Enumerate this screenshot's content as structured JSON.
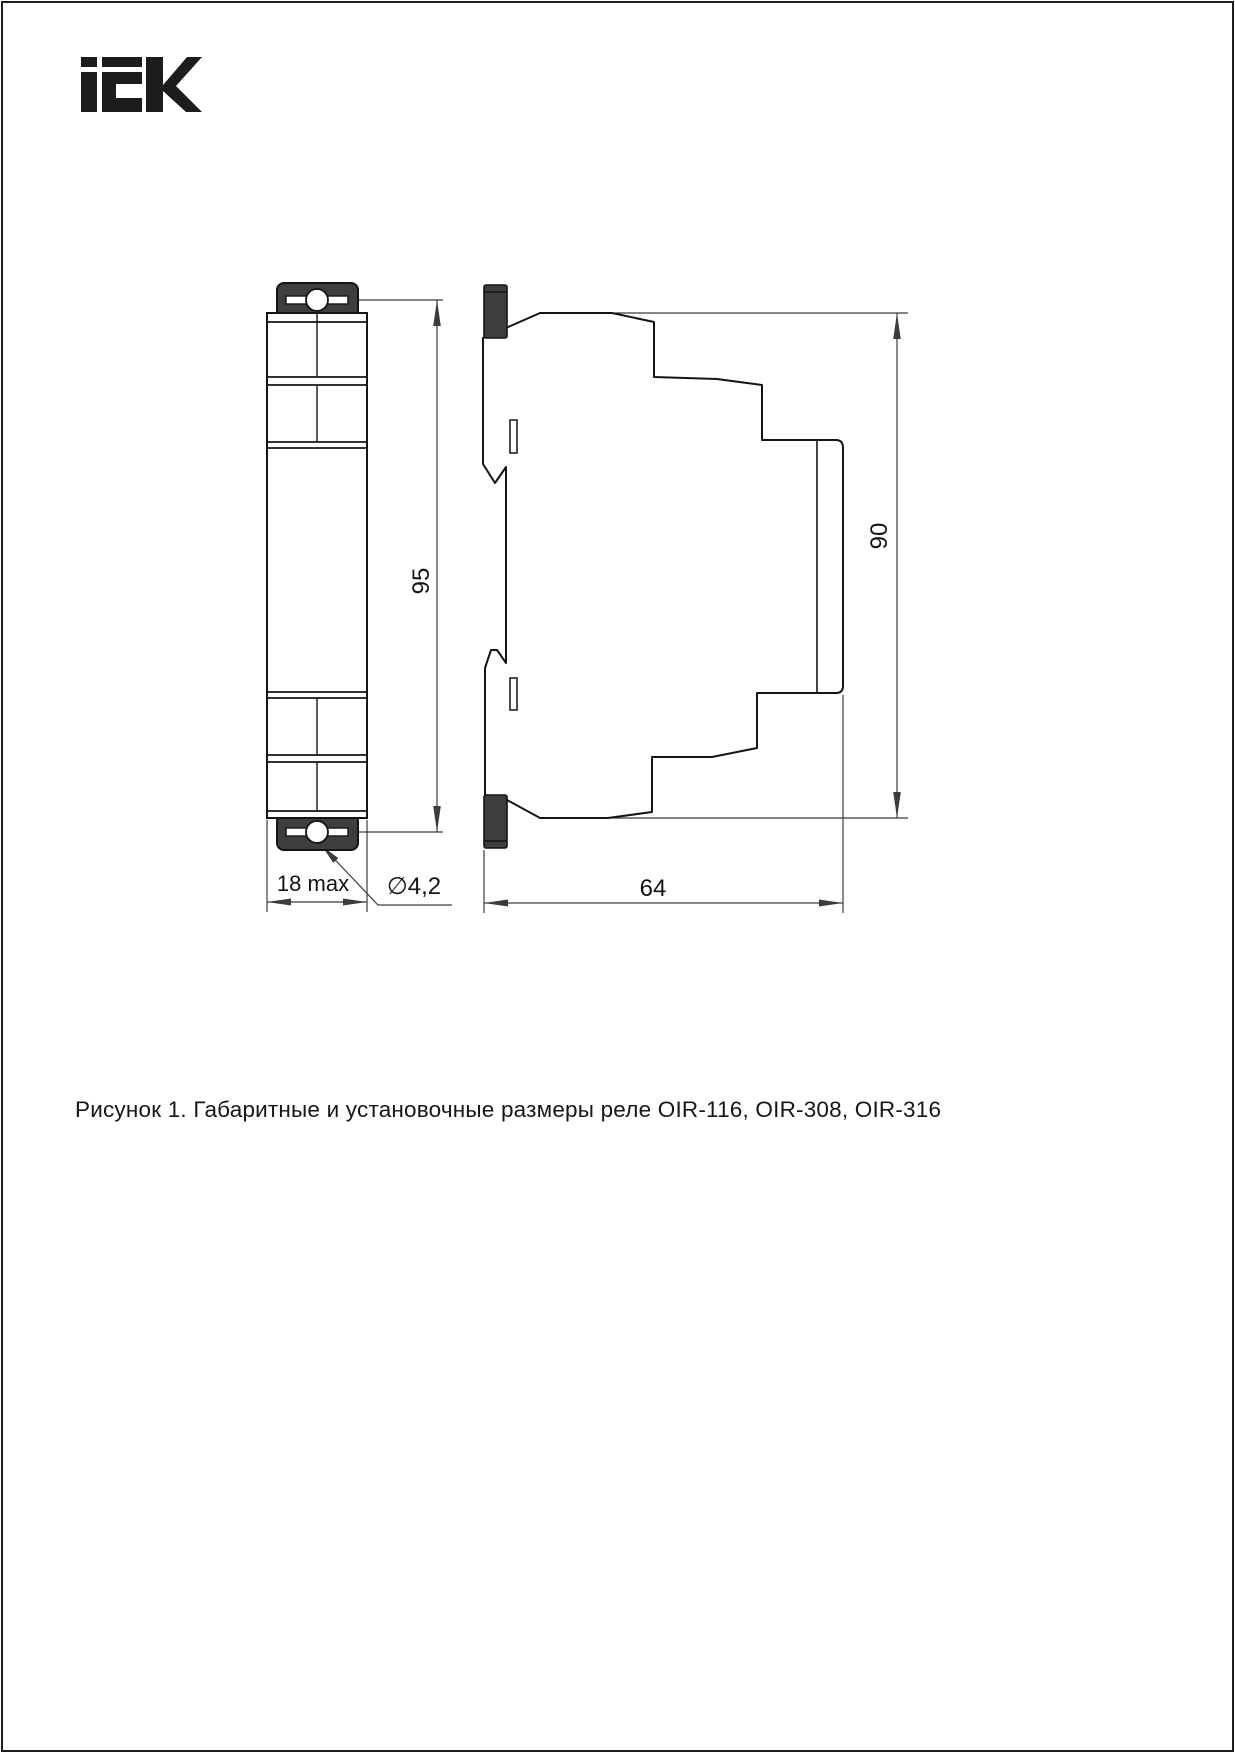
{
  "page": {
    "background": "#ffffff",
    "border_color": "#1f1f1f"
  },
  "logo": {
    "brand": "IEK",
    "color": "#1d1c1b"
  },
  "drawing": {
    "colors": {
      "outline": "#141414",
      "dimension": "#3c3c3c",
      "clip_fill": "#3e3e3e"
    },
    "front_view": {
      "dim_height_label": "95",
      "dim_width_label": "18 max",
      "dim_hole_label": "∅4,2"
    },
    "side_view": {
      "dim_height_label": "90",
      "dim_depth_label": "64"
    }
  },
  "caption": {
    "text": "Рисунок 1. Габаритные и установочные размеры реле OIR-116, OIR-308, OIR-316"
  }
}
